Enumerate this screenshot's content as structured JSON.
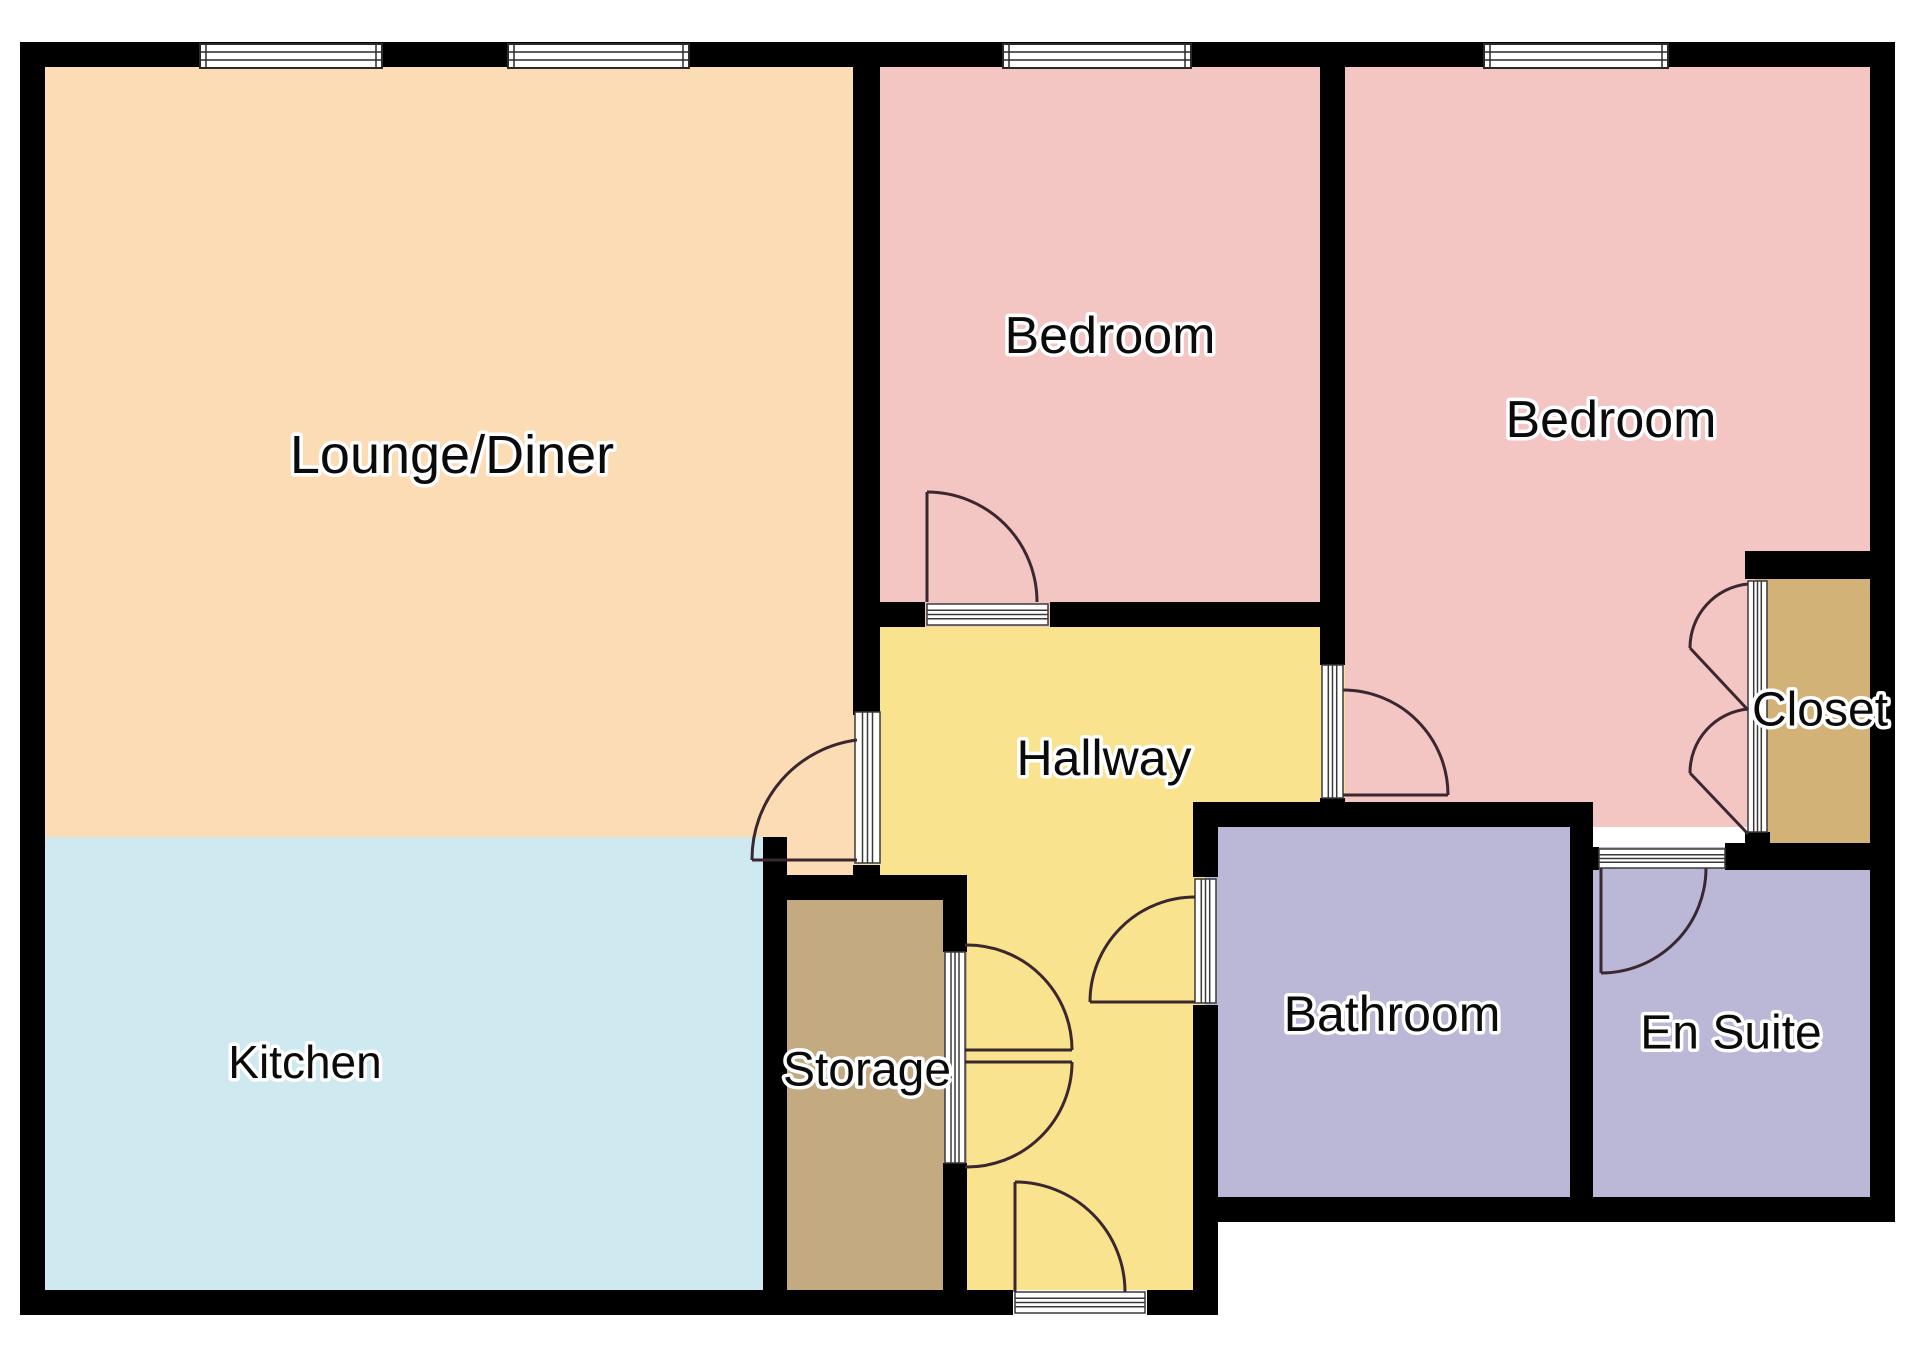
{
  "title": "Floor plan",
  "colors": {
    "background": "#ffffff",
    "wall": "#000000",
    "window_frame": "#2a2a2a",
    "door_track_line": "#3a3a3a",
    "door_arc": "#3a2730",
    "lounge": "#fcdcb4",
    "kitchen": "#cfe9f1",
    "bedroom": "#f3c6c3",
    "hallway": "#fae38e",
    "storage": "#c4aa80",
    "closet": "#d3b277",
    "bath": "#bab8d6"
  },
  "rooms": [
    {
      "name": "lounge-diner",
      "color": "lounge",
      "rects": [
        [
          45,
          67,
          835,
          770
        ],
        [
          763,
          837,
          117,
          63
        ]
      ]
    },
    {
      "name": "kitchen",
      "color": "kitchen",
      "rects": [
        [
          45,
          837,
          742,
          453
        ]
      ]
    },
    {
      "name": "bedroom-1",
      "color": "bedroom",
      "rects": [
        [
          868,
          67,
          477,
          560
        ]
      ]
    },
    {
      "name": "bedroom-2",
      "color": "bedroom",
      "rects": [
        [
          1333,
          67,
          549,
          760
        ]
      ]
    },
    {
      "name": "hallway",
      "color": "hallway",
      "rects": [
        [
          868,
          627,
          477,
          200
        ],
        [
          868,
          627,
          99,
          273
        ],
        [
          955,
          827,
          263,
          463
        ]
      ]
    },
    {
      "name": "storage",
      "color": "storage",
      "rects": [
        [
          787,
          900,
          180,
          390
        ]
      ]
    },
    {
      "name": "bathroom",
      "color": "bath",
      "rects": [
        [
          1205,
          827,
          388,
          383
        ]
      ]
    },
    {
      "name": "en-suite",
      "color": "bath",
      "rects": [
        [
          1581,
          847,
          301,
          363
        ]
      ]
    },
    {
      "name": "closet",
      "color": "closet",
      "rects": [
        [
          1755,
          579,
          127,
          289
        ]
      ]
    }
  ],
  "walls": [
    {
      "name": "outer-top",
      "rect": [
        20,
        42,
        1875,
        25
      ]
    },
    {
      "name": "outer-left",
      "rect": [
        20,
        42,
        25,
        1273
      ]
    },
    {
      "name": "outer-bottom-left-a",
      "rect": [
        20,
        1290,
        993,
        25
      ]
    },
    {
      "name": "outer-bottom-left-b",
      "rect": [
        1147,
        1290,
        71,
        25
      ]
    },
    {
      "name": "outer-right",
      "rect": [
        1870,
        42,
        25,
        1180
      ]
    },
    {
      "name": "outer-bottom-right",
      "rect": [
        1193,
        1197,
        702,
        25
      ]
    },
    {
      "name": "lounge-divider-upper",
      "rect": [
        853,
        67,
        27,
        648
      ]
    },
    {
      "name": "lounge-divider-lower",
      "rect": [
        853,
        865,
        27,
        35
      ]
    },
    {
      "name": "bedroom1-bottom-a",
      "rect": [
        853,
        602,
        72,
        25
      ]
    },
    {
      "name": "bedroom1-bottom-b",
      "rect": [
        1050,
        602,
        295,
        25
      ]
    },
    {
      "name": "bedroom-divider-upper",
      "rect": [
        1320,
        67,
        25,
        598
      ]
    },
    {
      "name": "bedroom-divider-lower",
      "rect": [
        1320,
        798,
        25,
        29
      ]
    },
    {
      "name": "bath-top",
      "rect": [
        1193,
        802,
        400,
        25
      ]
    },
    {
      "name": "hall-bath-upper",
      "rect": [
        1193,
        802,
        25,
        75
      ]
    },
    {
      "name": "hall-bath-lower",
      "rect": [
        1193,
        1005,
        25,
        310
      ]
    },
    {
      "name": "kitchen-east",
      "rect": [
        763,
        837,
        24,
        453
      ]
    },
    {
      "name": "storage-top",
      "rect": [
        787,
        875,
        180,
        25
      ]
    },
    {
      "name": "storage-east-a",
      "rect": [
        943,
        900,
        24,
        52
      ]
    },
    {
      "name": "storage-east-b",
      "rect": [
        943,
        1163,
        24,
        127
      ]
    },
    {
      "name": "bath-ensuite-divider",
      "rect": [
        1570,
        827,
        23,
        395
      ]
    },
    {
      "name": "ensuite-top-nub",
      "rect": [
        1570,
        847,
        29,
        23
      ]
    },
    {
      "name": "ensuite-top-east",
      "rect": [
        1725,
        843,
        157,
        27
      ]
    },
    {
      "name": "closet-top",
      "rect": [
        1745,
        551,
        137,
        28
      ]
    },
    {
      "name": "closet-track-foot",
      "rect": [
        1745,
        832,
        25,
        38
      ]
    }
  ],
  "windows": [
    {
      "name": "window-lounge-1",
      "rect": [
        200,
        44,
        182,
        24
      ]
    },
    {
      "name": "window-lounge-2",
      "rect": [
        508,
        44,
        181,
        24
      ]
    },
    {
      "name": "window-bedroom-1",
      "rect": [
        1003,
        44,
        188,
        24
      ]
    },
    {
      "name": "window-bedroom-2",
      "rect": [
        1484,
        44,
        184,
        24
      ]
    }
  ],
  "door_tracks": [
    {
      "name": "track-lounge-door",
      "rect": [
        855,
        712,
        25,
        151
      ]
    },
    {
      "name": "track-bedroom1-door",
      "rect": [
        927,
        604,
        121,
        21
      ]
    },
    {
      "name": "track-bedroom2-door",
      "rect": [
        1322,
        665,
        21,
        133
      ]
    },
    {
      "name": "track-bathroom-door",
      "rect": [
        1195,
        879,
        21,
        124
      ]
    },
    {
      "name": "track-storage-doors",
      "rect": [
        945,
        952,
        20,
        211
      ]
    },
    {
      "name": "track-front-door",
      "rect": [
        1015,
        1292,
        130,
        21
      ]
    },
    {
      "name": "track-ensuite-door",
      "rect": [
        1599,
        849,
        126,
        19
      ]
    },
    {
      "name": "track-closet-doors",
      "rect": [
        1748,
        581,
        19,
        251
      ]
    }
  ],
  "doors": [
    {
      "name": "door-lounge",
      "leaf": [
        857,
        860,
        752,
        860
      ],
      "arc": "M 752 860 A 120 120 0 0 1 857 740"
    },
    {
      "name": "door-bedroom-1",
      "leaf": [
        927,
        602,
        927,
        492
      ],
      "arc": "M 927 492 A 110 110 0 0 1 1037 602"
    },
    {
      "name": "door-bedroom-2",
      "leaf": [
        1343,
        795,
        1448,
        795
      ],
      "arc": "M 1448 795 A 105 105 0 0 0 1343 690"
    },
    {
      "name": "door-bathroom",
      "leaf": [
        1195,
        1002,
        1090,
        1002
      ],
      "arc": "M 1090 1002 A 105 105 0 0 1 1195 897"
    },
    {
      "name": "door-storage-upper",
      "leaf": [
        965,
        1050,
        1072,
        1050
      ],
      "arc": "M 1072 1050 A 105 105 0 0 0 965 945"
    },
    {
      "name": "door-storage-lower",
      "leaf": [
        965,
        1062,
        1072,
        1062
      ],
      "arc": "M 1072 1062 A 105 105 0 0 1 965 1167"
    },
    {
      "name": "door-front-entrance",
      "leaf": [
        1015,
        1292,
        1015,
        1182
      ],
      "arc": "M 1015 1182 A 110 110 0 0 1 1125 1292"
    },
    {
      "name": "door-ensuite",
      "leaf": [
        1601,
        868,
        1601,
        973
      ],
      "arc": "M 1601 973 A 105 105 0 0 0 1706 868"
    },
    {
      "name": "closet-bifold-1",
      "leaf": [
        1690,
        648,
        1748,
        710
      ],
      "arc": "M 1690 648 A 64 64 0 0 1 1748 584"
    },
    {
      "name": "closet-bifold-2",
      "leaf": [
        1690,
        773,
        1748,
        834
      ],
      "arc": "M 1690 773 A 64 64 0 0 1 1748 709"
    }
  ],
  "labels": [
    {
      "id": "lounge",
      "text": "Lounge/Diner",
      "x": 452,
      "y": 455,
      "size": 54
    },
    {
      "id": "bedroom1",
      "text": "Bedroom",
      "x": 1110,
      "y": 336,
      "size": 52
    },
    {
      "id": "bedroom2",
      "text": "Bedroom",
      "x": 1611,
      "y": 420,
      "size": 52
    },
    {
      "id": "hallway",
      "text": "Hallway",
      "x": 1104,
      "y": 758,
      "size": 50
    },
    {
      "id": "closet",
      "text": "Closet",
      "x": 1820,
      "y": 710,
      "size": 48
    },
    {
      "id": "kitchen",
      "text": "Kitchen",
      "x": 305,
      "y": 1062,
      "size": 46
    },
    {
      "id": "storage",
      "text": "Storage",
      "x": 867,
      "y": 1070,
      "size": 48
    },
    {
      "id": "bathroom",
      "text": "Bathroom",
      "x": 1392,
      "y": 1014,
      "size": 50
    },
    {
      "id": "ensuite",
      "text": "En Suite",
      "x": 1731,
      "y": 1033,
      "size": 48
    }
  ]
}
